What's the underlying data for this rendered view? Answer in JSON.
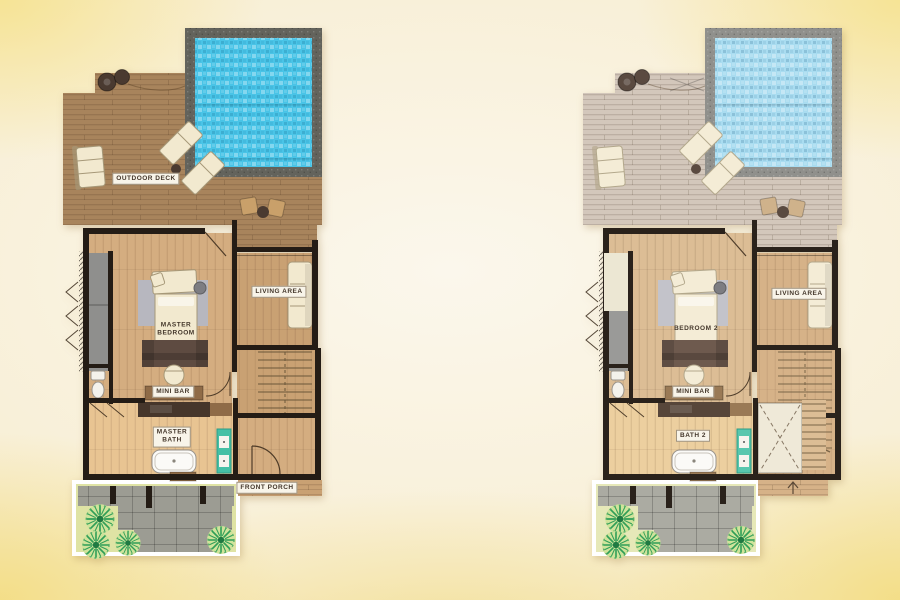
{
  "plans": [
    {
      "labels": {
        "deck": "OUTDOOR DECK",
        "living": "LIVING AREA",
        "bedroom": "MASTER\nBEDROOM",
        "minibar": "MINI BAR",
        "bath": "MASTER\nBATH",
        "porch": "FRONT PORCH"
      }
    },
    {
      "labels": {
        "living": "LIVING AREA",
        "bedroom": "BEDROOM 2",
        "minibar": "MINI BAR",
        "bath": "BATH 2"
      }
    }
  ],
  "palette": {
    "background_wash": "#f8efd6",
    "background_corner_yellow": "#f1dc93",
    "deck_wood": "#a8845c",
    "deck_wood_faded": "#d3c7bb",
    "pool_water": "#49c4e7",
    "pool_water_faded": "#a9dcf0",
    "pool_coping": "#63635c",
    "bedroom_floor": "#d4ad80",
    "bath_floor": "#e8c492",
    "wall": "#241c15",
    "rug_gray": "#b7b7bf",
    "linen_cream": "#f2e9cf",
    "headboard_brown": "#5e4b41",
    "minibar_wood": "#8f6b47",
    "vanity_wood": "#46362b",
    "cabinet_teal": "#45c0a5",
    "courtyard_ground": "#dfe3a4",
    "paver_gray": "#9c9c93",
    "plant_green": "#2f9e58",
    "label_text": "#43362a",
    "label_background": "#f8f4e9"
  }
}
